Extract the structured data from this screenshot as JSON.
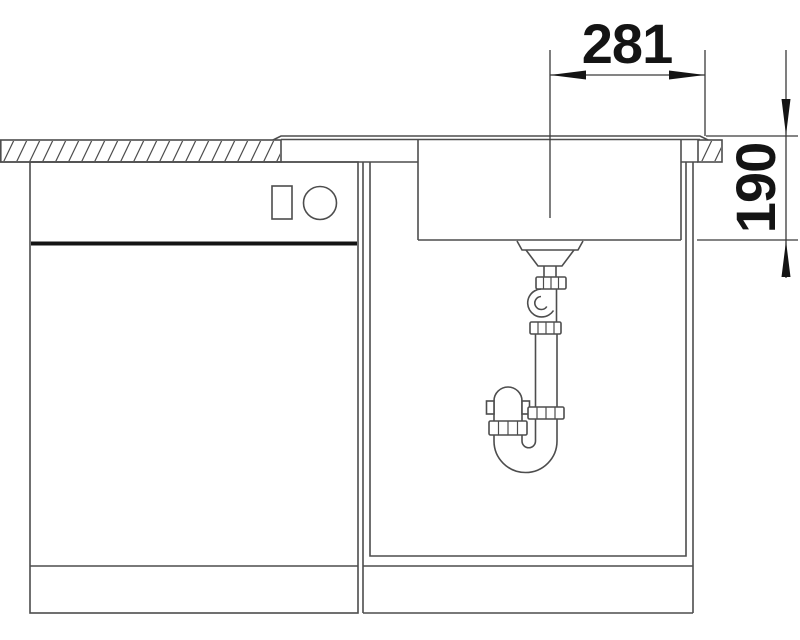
{
  "drawing": {
    "kind": "technical-cross-section",
    "subject": "kitchen-sink-with-base-cabinet-and-siphon",
    "dimensions": [
      {
        "id": "width",
        "label": "281",
        "orientation": "horizontal"
      },
      {
        "id": "depth",
        "label": "190",
        "orientation": "vertical"
      }
    ],
    "colors": {
      "background": "#ffffff",
      "line": "#4d4d4d",
      "dim": "#3a3a3a",
      "ink": "#141414"
    }
  }
}
